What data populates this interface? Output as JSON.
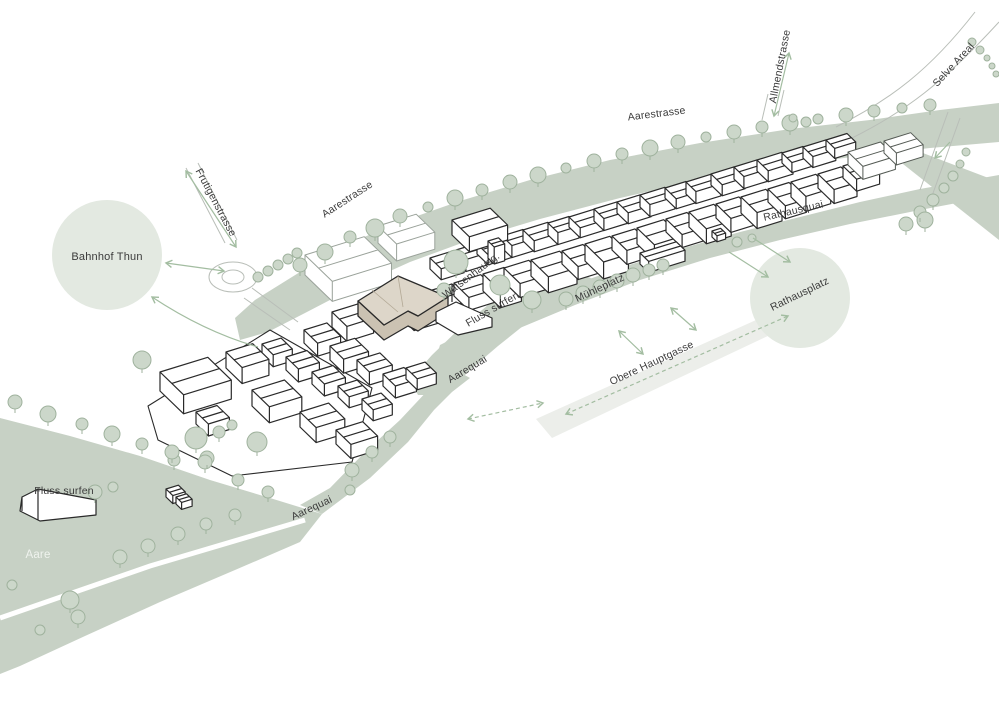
{
  "map": {
    "title": "Thun Aare riverfront site plan",
    "labels": [
      {
        "id": "bahnhof-thun",
        "text": "Bahnhof Thun",
        "transform": "translate(107,260)"
      },
      {
        "id": "frutigenstrasse",
        "text": "Frutigenstrasse",
        "transform": "translate(213,204) rotate(62)"
      },
      {
        "id": "aarestrasse-west",
        "text": "Aarestrasse",
        "transform": "translate(349,202) rotate(-33)"
      },
      {
        "id": "aarestrasse-north",
        "text": "Aarestrasse",
        "transform": "translate(657,117) rotate(-7)"
      },
      {
        "id": "allmendstrasse",
        "text": "Allmendstrasse",
        "transform": "translate(783,67) rotate(-79)"
      },
      {
        "id": "selve-areal",
        "text": "Selve Areal",
        "transform": "translate(956,67) rotate(-47)"
      },
      {
        "id": "rathausquai",
        "text": "Rathausquai",
        "transform": "translate(794,214) rotate(-13)"
      },
      {
        "id": "rathausplatz",
        "text": "Rathausplatz",
        "transform": "translate(801,297) rotate(-26)"
      },
      {
        "id": "waisenhausgasse",
        "text": "Waisenhausg.",
        "transform": "translate(473,278) rotate(-37)"
      },
      {
        "id": "fluss-surfen-mid",
        "text": "Fluss surfen",
        "transform": "translate(494,312) rotate(-30)"
      },
      {
        "id": "muehleplatz",
        "text": "Mühleplatz",
        "transform": "translate(601,291) rotate(-25)"
      },
      {
        "id": "obere-hauptgasse",
        "text": "Obere Hauptgasse",
        "transform": "translate(653,366) rotate(-25)"
      },
      {
        "id": "aarequai-upper",
        "text": "Aarequai",
        "transform": "translate(469,372) rotate(-31)"
      },
      {
        "id": "aarequai-lower",
        "text": "Aarequai",
        "transform": "translate(313,511) rotate(-25)"
      },
      {
        "id": "fluss-surfen-west",
        "text": "Fluss surfen",
        "transform": "translate(64,494)"
      },
      {
        "id": "aare",
        "text": "Aare",
        "transform": "translate(38,558)"
      }
    ],
    "colors": {
      "river": "#c7d1c5",
      "plaza_circle": "#e3e9e1",
      "street_band": "#eceeea",
      "tree_fill": "#ccd7ca",
      "tree_stroke": "#9fb29d",
      "arrow": "#a3bda1",
      "outline_dark": "#2a2a2a",
      "outline_gray": "#9aa29a",
      "road": "#b9beb8",
      "highlight_roof": "#ddd6c9",
      "highlight_wall": "#cbc2b2",
      "label": "#3b3b3b",
      "aare_label": "#eff3ee"
    }
  }
}
